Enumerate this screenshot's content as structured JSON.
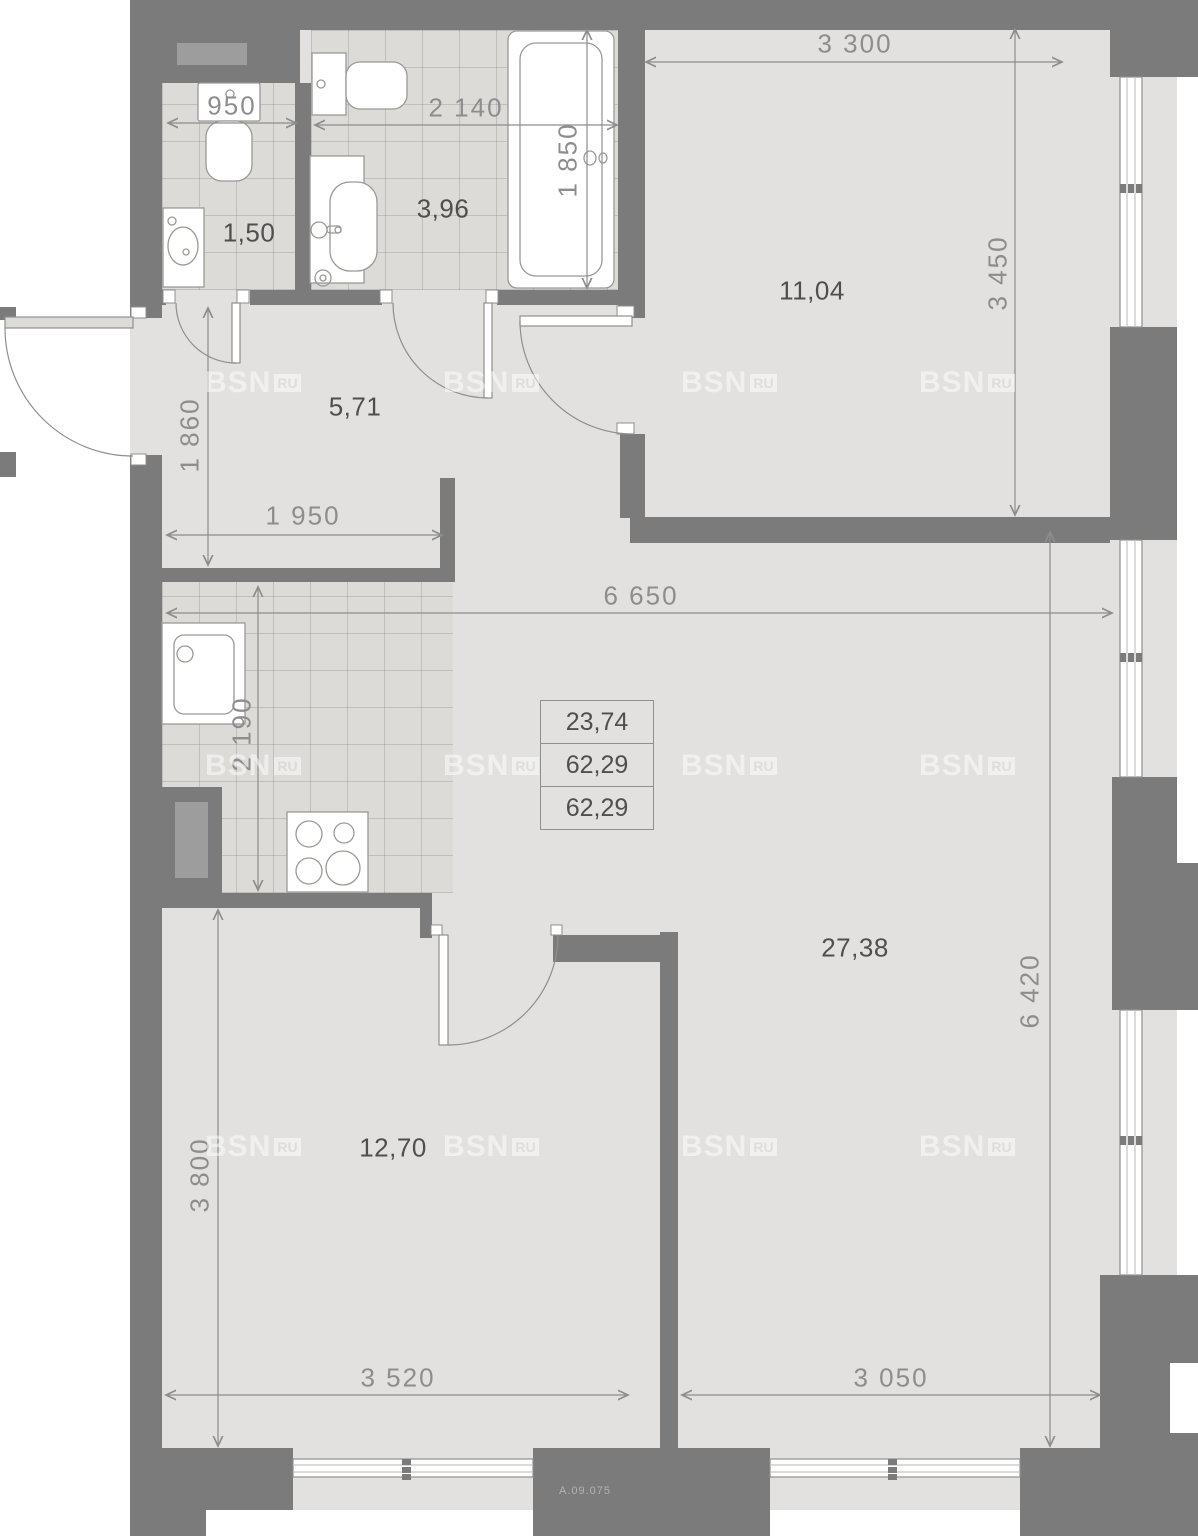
{
  "plan_code": "A.09.075",
  "watermark": {
    "brand": "BSN",
    "suffix": "RU"
  },
  "areas": {
    "wc": "1,50",
    "bathroom": "3,96",
    "hall": "5,71",
    "bedroom": "11,04",
    "living": "27,38",
    "room": "12,70"
  },
  "summary": {
    "row1": "23,74",
    "row2": "62,29",
    "row3": "62,29"
  },
  "dims": {
    "d950": "950",
    "d2140": "2 140",
    "d1850": "1 850",
    "d3300": "3 300",
    "d3450": "3 450",
    "d1860": "1 860",
    "d1950": "1 950",
    "d6650": "6 650",
    "d2190": "2 190",
    "d3800": "3 800",
    "d3520": "3 520",
    "d3050": "3 050",
    "d6420": "6 420"
  },
  "colors": {
    "wall": "#7b7b7b",
    "floor": "#e2e1df",
    "tile": "#dcdbd8",
    "dimension": "#8d8d8d",
    "room_label": "#4f4f4f",
    "fixture_stroke": "#999996",
    "watermark": "#ffffff"
  }
}
